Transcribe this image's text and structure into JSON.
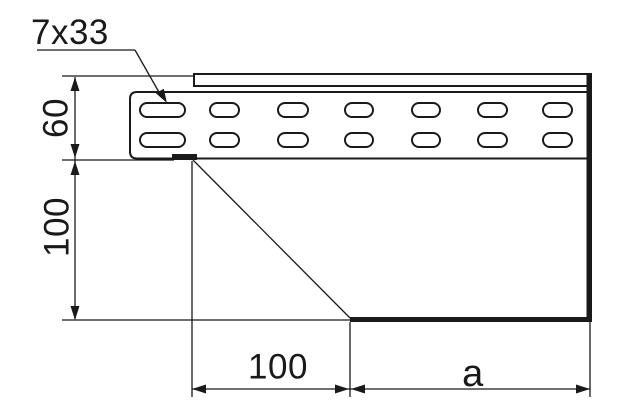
{
  "drawing_type": "technical-drawing-side-view",
  "colors": {
    "ink": "#1a1a1a",
    "paper": "#ffffff"
  },
  "callout": {
    "label": "7x33"
  },
  "dimensions": {
    "side_height": "60",
    "drop_height": "100",
    "offset_width": "100",
    "length": "a"
  }
}
